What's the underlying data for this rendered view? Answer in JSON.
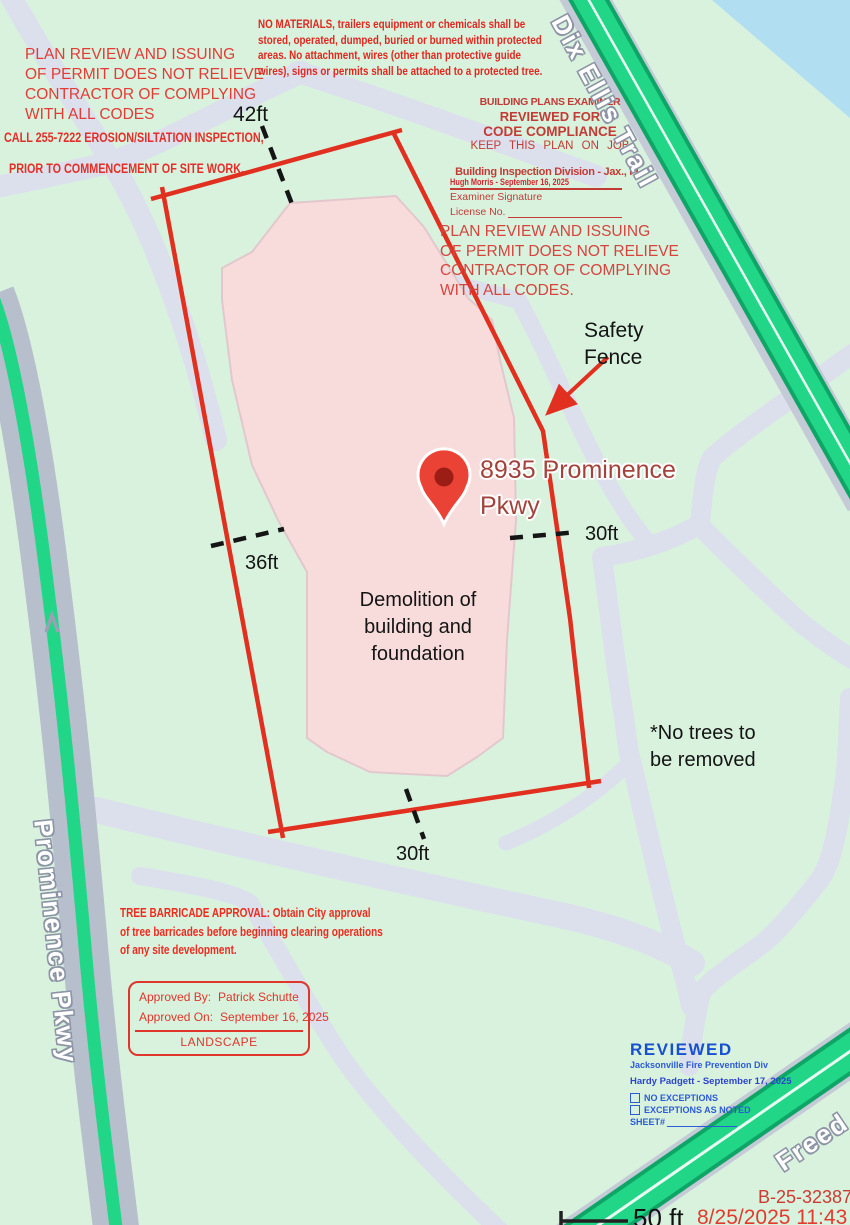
{
  "map": {
    "roads": {
      "dix_ellis_trail": "Dix Ellis Trail",
      "prominence_pkwy": "Prominence Pkwy",
      "freedom": "Freed"
    },
    "pin_address": {
      "line1": "8935 Prominence",
      "line2": "Pkwy"
    },
    "annotations": {
      "safety_fence": [
        "Safety",
        "Fence"
      ],
      "demolition": [
        "Demolition of",
        "building and",
        "foundation"
      ],
      "no_trees": [
        "*No trees to",
        "be removed"
      ]
    },
    "dimensions": {
      "top": "42ft",
      "left": "36ft",
      "right": "30ft",
      "bottom": "30ft"
    },
    "scale": "50 ft",
    "icons": {
      "map_pin": "red teardrop location marker",
      "safety_fence_arrow": "red arrow pointing to fence line",
      "one_way_arrow": "gray up chevron on road"
    }
  },
  "notices": {
    "plan_review_top": [
      "PLAN REVIEW AND ISSUING",
      "OF PERMIT DOES NOT RELIEVE",
      "CONTRACTOR OF COMPLYING",
      "WITH ALL CODES"
    ],
    "erosion": [
      "CALL 255-7222 EROSION/SILTATION INSPECTION,",
      "PRIOR TO COMMENCEMENT OF SITE WORK."
    ],
    "no_materials": [
      "NO MATERIALS, trailers equipment or chemicals shall be",
      "stored, operated, dumped, buried or burned within protected",
      "areas.  No attachment, wires (other than protective guide",
      "wires), signs or permits shall be attached to a protected tree."
    ],
    "plan_review_right": [
      "PLAN REVIEW AND ISSUING",
      "OF PERMIT DOES NOT RELIEVE",
      "CONTRACTOR OF COMPLYING",
      "WITH ALL CODES."
    ],
    "tree_barricade": [
      "TREE BARRICADE APPROVAL:  Obtain City approval",
      "of tree barricades before beginning clearing operations",
      "of any site development."
    ]
  },
  "examiner_stamp": {
    "title": "BUILDING PLANS EXAMINER",
    "line2": "REVIEWED FOR",
    "line3": "CODE COMPLIANCE",
    "line4": "KEEP THIS PLAN ON JOB",
    "division": "Building Inspection Division - Jax., FL.",
    "signature": "Hugh Morris - September 16, 2025",
    "signature_label": "Examiner Signature",
    "license_label": "License No."
  },
  "approval_stamp": {
    "by_label": "Approved By:",
    "by_value": "Patrick Schutte",
    "on_label": "Approved On:",
    "on_value": "September 16, 2025",
    "category": "LANDSCAPE"
  },
  "fire_stamp": {
    "title": "REVIEWED",
    "org": "Jacksonville Fire Prevention Div",
    "signature": "Hardy Padgett - September 17, 2025",
    "option1": "NO EXCEPTIONS",
    "option2": "EXCEPTIONS AS NOTED",
    "sheet_label": "SHEET#"
  },
  "footer": {
    "permit_number": "B-25-32387",
    "print_time": "8/25/2025 11:43"
  },
  "colors": {
    "boundary_red": "#e1301f",
    "notice_red": "#e13c36",
    "stamp_red": "#c33b35",
    "fire_blue": "#1751cf",
    "road_green": "#21d687",
    "water_blue": "#b1def1",
    "building_pink": "#f8dcdc",
    "path_gray": "#dcdfec",
    "map_green": "#d9f2de"
  }
}
